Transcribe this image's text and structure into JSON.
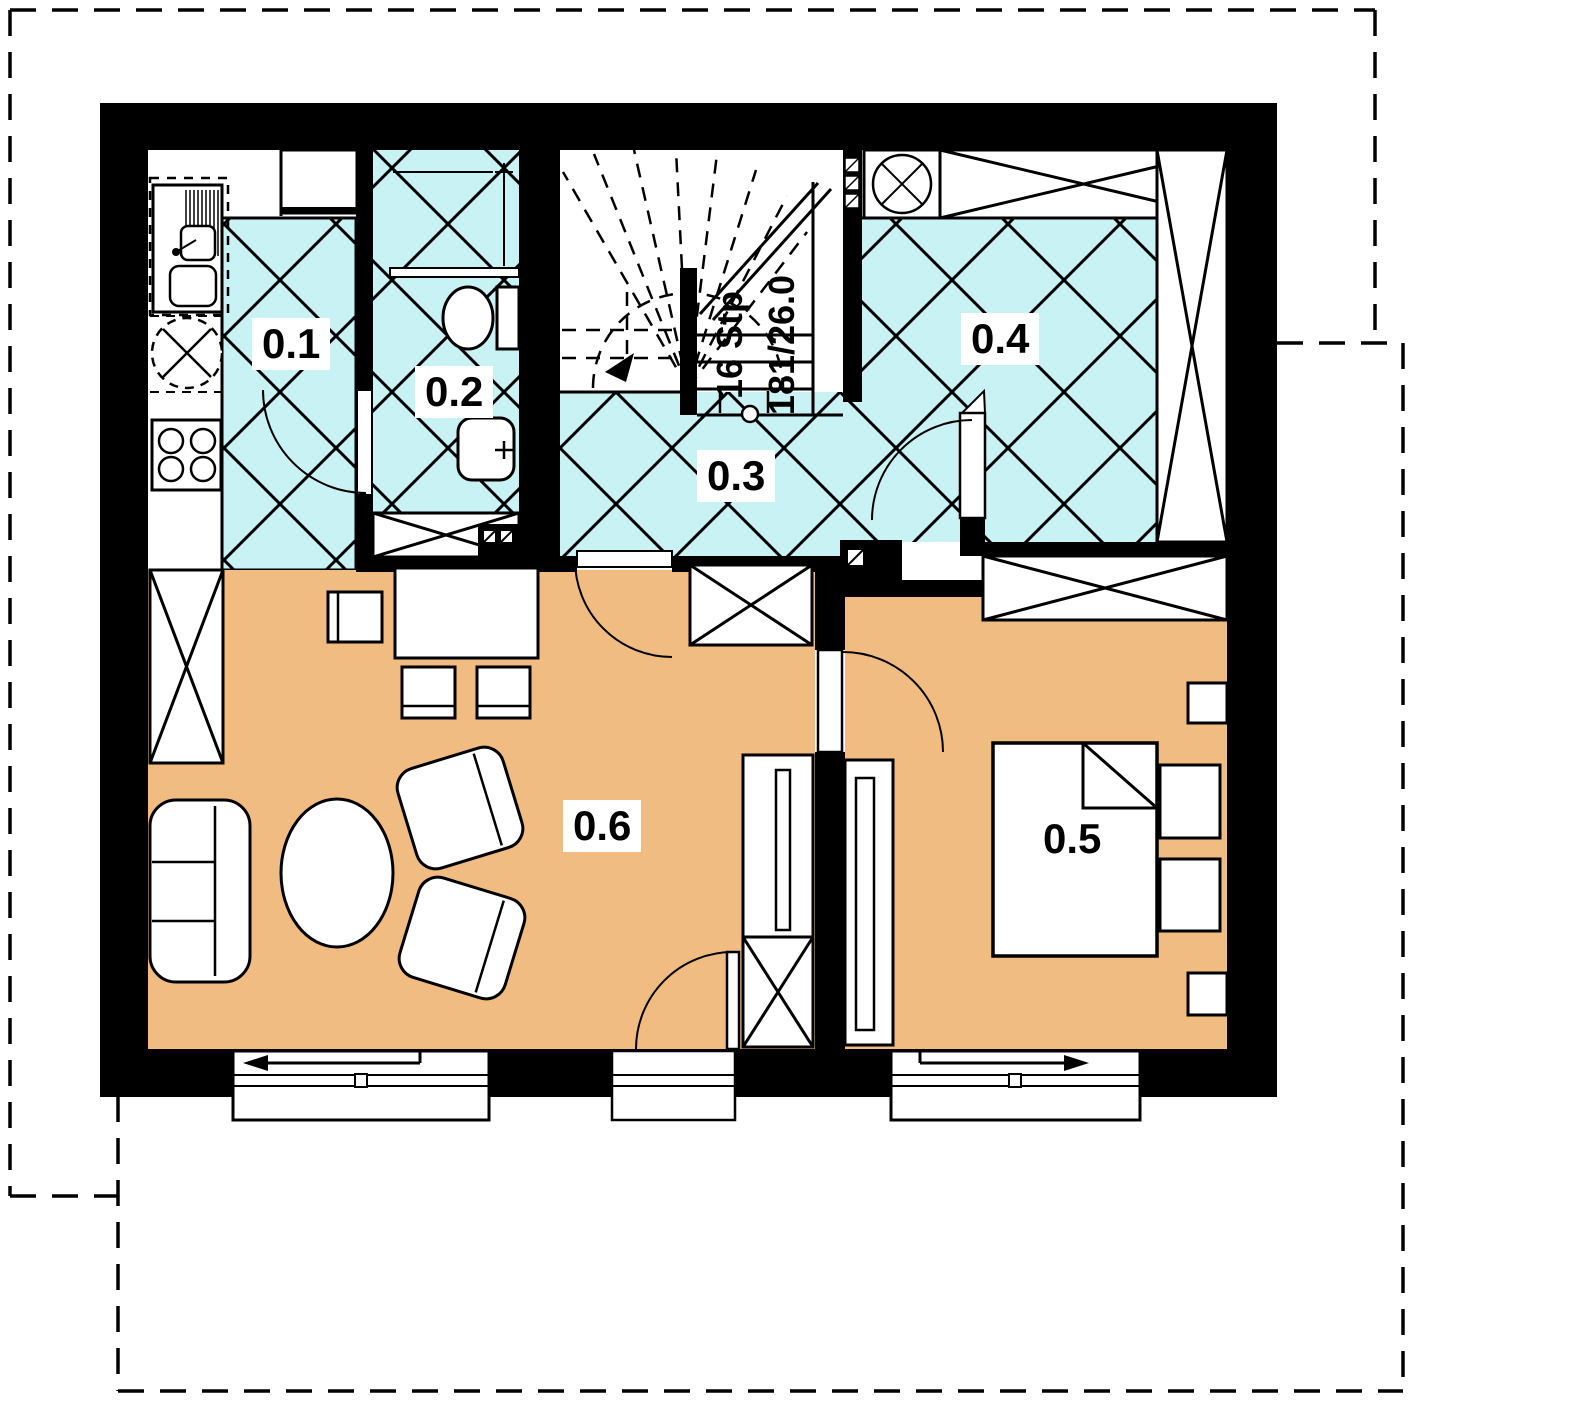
{
  "rooms": [
    {
      "label": "0.1"
    },
    {
      "label": "0.2"
    },
    {
      "label": "0.3"
    },
    {
      "label": "0.4"
    },
    {
      "label": "0.5"
    },
    {
      "label": "0.6"
    }
  ],
  "stairs": {
    "steps_label": "16 Stp",
    "dimension_label": "181/26.0"
  },
  "colors": {
    "tile_floor": "#c9f2f4",
    "wood_floor": "#f0bc82",
    "wall": "#000000",
    "background": "#ffffff"
  }
}
